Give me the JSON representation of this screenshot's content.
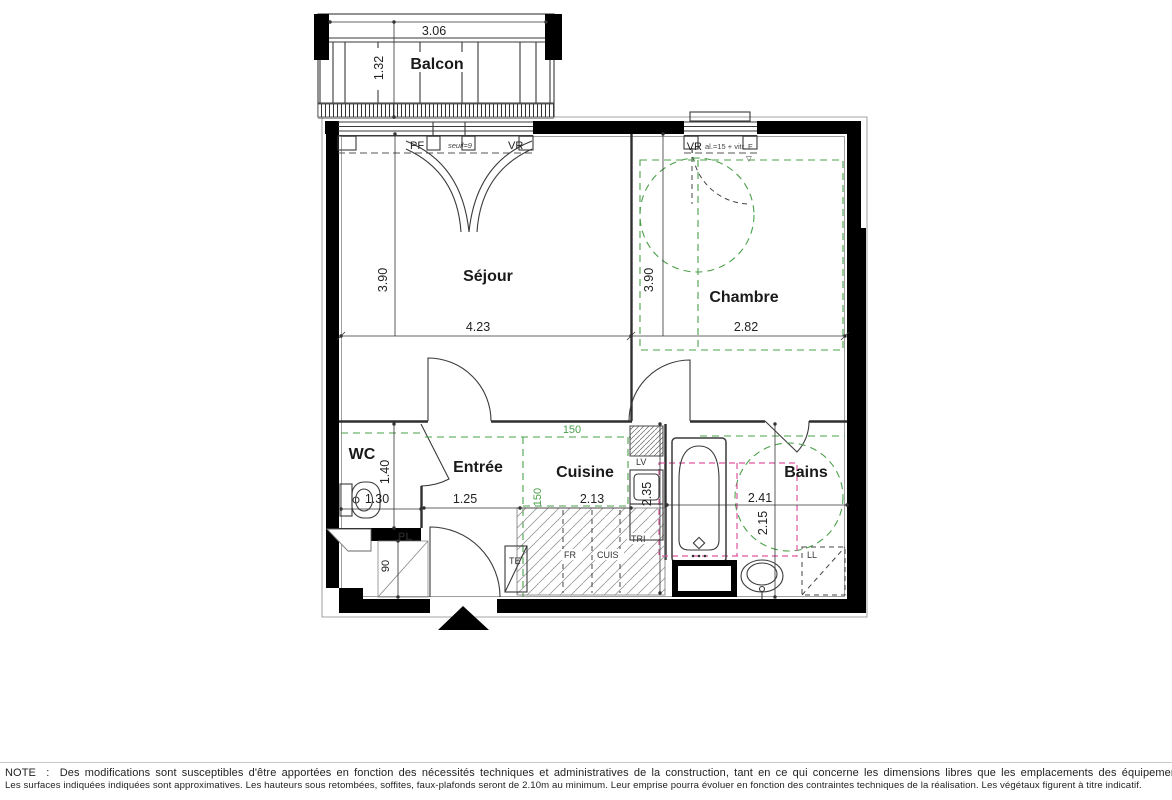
{
  "colors": {
    "wall": "#000000",
    "green": "#4aa04a",
    "pink": "#e0559e"
  },
  "plan": {
    "balcony": {
      "label": "Balcon",
      "width": "3.06",
      "depth": "1.32"
    },
    "rooms": {
      "sejour": {
        "label": "Séjour",
        "height": "3.90",
        "width": "4.23"
      },
      "chambre": {
        "label": "Chambre",
        "height": "3.90",
        "width": "2.82"
      },
      "wc": {
        "label": "WC",
        "height": "1.40",
        "width": "1.30"
      },
      "entree": {
        "label": "Entrée",
        "width": "1.25"
      },
      "cuisine": {
        "label": "Cuisine",
        "width": "2.13",
        "height": "2.35",
        "clear_w": "150",
        "clear_h": "150"
      },
      "bains": {
        "label": "Bains",
        "width": "2.41",
        "height": "2.15"
      }
    },
    "windows": {
      "sejour_left": "PF",
      "sejour_seuil": "seuil=9",
      "sejour_right": "VR",
      "chambre_code": "VR",
      "chambre_note": "al.=15 + vitr. F",
      "chambre_marker": "▽"
    },
    "fixtures": {
      "placard": "PL",
      "placard_dim": "90",
      "lave_vaisselle": "LV",
      "tri": "TRI",
      "frigo": "FR",
      "cuisiniere": "CUIS",
      "tableau": "TE",
      "lave_linge": "LL"
    }
  },
  "note": {
    "line1": "NOTE  :  Des modifications sont susceptibles d'être apportées en fonction des nécessités techniques et administratives de la construction, tant en ce qui concerne les dimensions libres que les emplacements des équipements.",
    "line2": "Les surfaces indiquées indiquées sont approximatives. Les hauteurs sous retombées, soffites, faux-plafonds seront de 2.10m au minimum. Leur emprise pourra évoluer en fonction des contraintes techniques de la réalisation. Les végétaux figurent à titre indicatif."
  }
}
